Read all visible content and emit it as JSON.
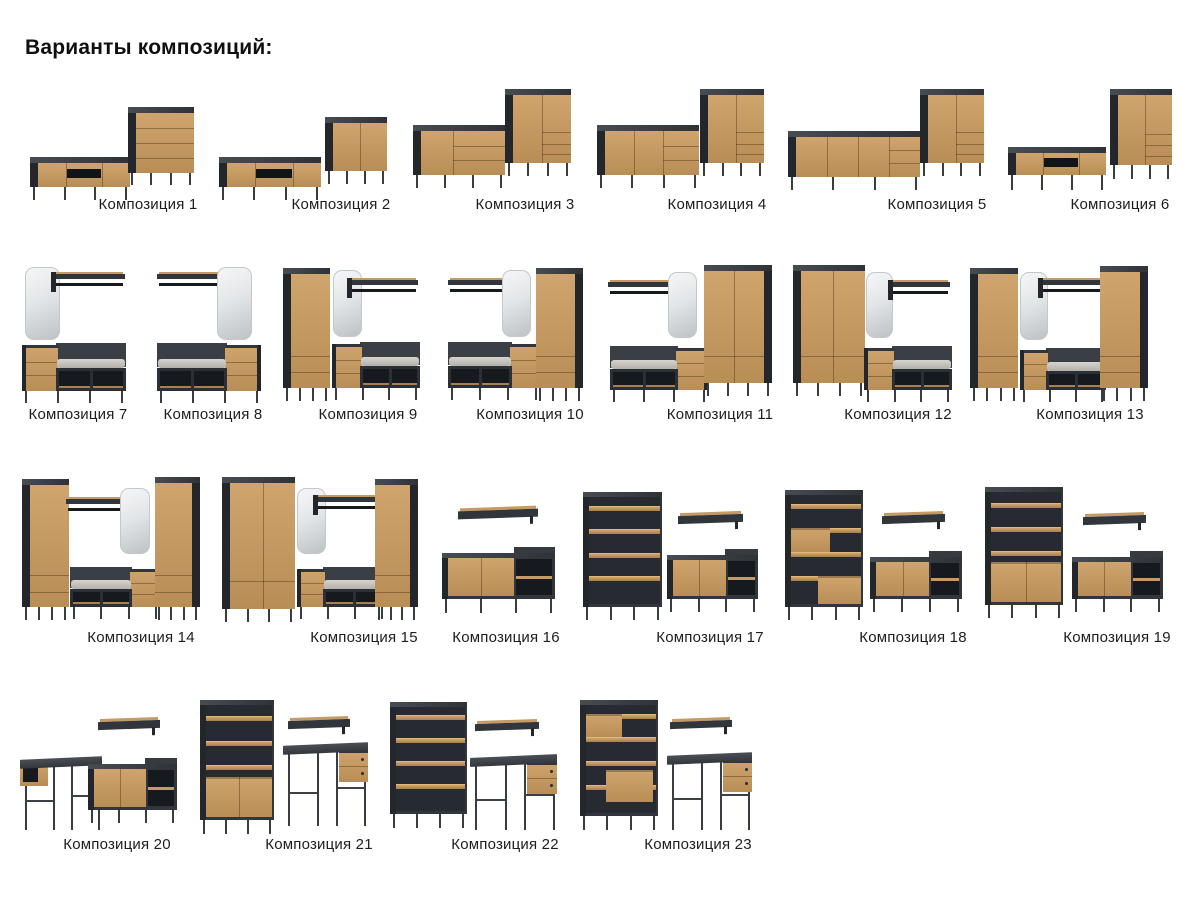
{
  "page_title": "Варианты композиций:",
  "colors": {
    "background": "#ffffff",
    "wood": "#c59a64",
    "wood_dark": "#a87f4e",
    "charcoal": "#30353b",
    "charcoal_deep": "#1d2126",
    "cushion": "#c6c3bd",
    "mirror": "#dfe2e4",
    "text": "#1e1e1e"
  },
  "compositions": [
    {
      "label": "Композиция 1",
      "pieces": [
        "tv-stand",
        "drawer-chest"
      ]
    },
    {
      "label": "Композиция 2",
      "pieces": [
        "tv-stand",
        "two-door-cabinet"
      ]
    },
    {
      "label": "Композиция 3",
      "pieces": [
        "sideboard",
        "tall-cabinet"
      ]
    },
    {
      "label": "Композиция 4",
      "pieces": [
        "sideboard-wide",
        "tall-cabinet"
      ]
    },
    {
      "label": "Композиция 5",
      "pieces": [
        "sideboard-long",
        "tall-cabinet"
      ]
    },
    {
      "label": "Композиция 6",
      "pieces": [
        "tv-stand",
        "tall-cabinet"
      ]
    },
    {
      "label": "Композиция 7",
      "pieces": [
        "mirror",
        "coat-rack",
        "hallway-bench"
      ]
    },
    {
      "label": "Композиция 8",
      "pieces": [
        "coat-rack",
        "mirror",
        "hallway-bench"
      ]
    },
    {
      "label": "Композиция 9",
      "pieces": [
        "wardrobe",
        "mirror",
        "coat-rack",
        "hallway-bench"
      ]
    },
    {
      "label": "Композиция 10",
      "pieces": [
        "coat-rack",
        "mirror",
        "wardrobe",
        "hallway-bench"
      ]
    },
    {
      "label": "Композиция 11",
      "pieces": [
        "coat-rack",
        "mirror",
        "hallway-bench",
        "two-door-wardrobe"
      ]
    },
    {
      "label": "Композиция 12",
      "pieces": [
        "two-door-wardrobe",
        "mirror",
        "coat-rack",
        "hallway-bench"
      ]
    },
    {
      "label": "Композиция 13",
      "pieces": [
        "wardrobe",
        "mirror",
        "coat-rack",
        "hallway-bench",
        "wardrobe"
      ]
    },
    {
      "label": "Композиция 14",
      "pieces": [
        "wardrobe",
        "coat-rack",
        "mirror",
        "hallway-bench",
        "wardrobe"
      ]
    },
    {
      "label": "Композиция 15",
      "pieces": [
        "two-door-wardrobe",
        "mirror",
        "coat-rack",
        "hallway-bench",
        "wardrobe"
      ]
    },
    {
      "label": "Композиция 16",
      "pieces": [
        "wall-shelf",
        "sideboard-open"
      ]
    },
    {
      "label": "Композиция 17",
      "pieces": [
        "bookcase",
        "wall-shelf",
        "sideboard-open"
      ]
    },
    {
      "label": "Композиция 18",
      "pieces": [
        "bookcase-with-inserts",
        "wall-shelf",
        "sideboard-open"
      ]
    },
    {
      "label": "Композиция 19",
      "pieces": [
        "bookcase-with-doors",
        "wall-shelf",
        "sideboard-open"
      ]
    },
    {
      "label": "Композиция 20",
      "pieces": [
        "desk-with-return",
        "wall-shelf",
        "sideboard-open"
      ]
    },
    {
      "label": "Композиция 21",
      "pieces": [
        "bookcase-with-doors",
        "wall-shelf",
        "desk"
      ]
    },
    {
      "label": "Композиция 22",
      "pieces": [
        "bookcase",
        "wall-shelf",
        "desk"
      ]
    },
    {
      "label": "Композиция 23",
      "pieces": [
        "bookcase-with-inserts",
        "wall-shelf",
        "desk"
      ]
    }
  ]
}
